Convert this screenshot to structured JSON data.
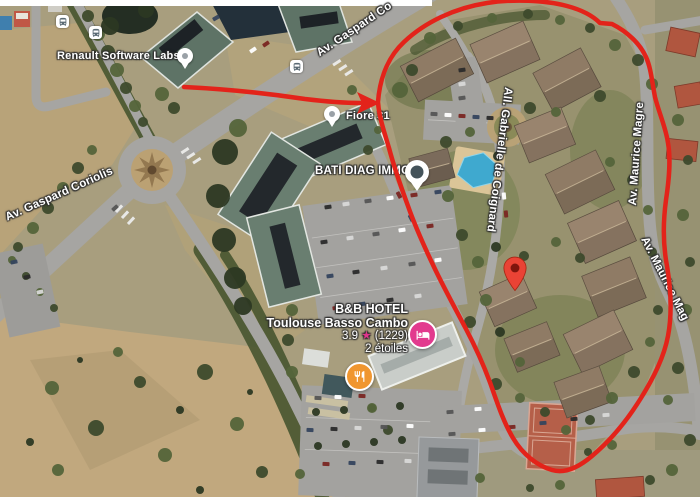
{
  "map": {
    "poi_labels": {
      "renault": "Renault Software Labs",
      "fiore": "Fiore 31",
      "bati_diag": "BATI DIAG IMMO"
    },
    "street_labels": {
      "gaspard_top": "Av. Gaspard Co",
      "gaspard_left": "Av. Gaspard Coriolis",
      "gabrielle": "All. Gabrielle de Coignard",
      "maurice_vertical": "Av. Maurice Magre",
      "maurice_diagonal": "Av. Maurice Mag"
    },
    "hotel_label": {
      "name_line1": "B&B HOTEL",
      "name_line2": "Toulouse Basso Cambo",
      "rating": "3.9",
      "star_icon": "★",
      "review_count": "(1229)",
      "category": "2 étoiles"
    },
    "icons": {
      "bus_stop": "bus-icon",
      "hotel_marker": "bed-icon",
      "restaurant_marker": "fork-knife-icon",
      "destination": "map-pin-icon",
      "poi": "dot-pin-icon"
    },
    "colors": {
      "annotation_red": "#E3231A",
      "destination_pin": "#EA4335",
      "hotel_marker_pink": "#E23A8E",
      "restaurant_marker_orange": "#F0962F",
      "rating_star_pink": "#E0368C",
      "poi_pin_dark": "#44535A"
    }
  }
}
